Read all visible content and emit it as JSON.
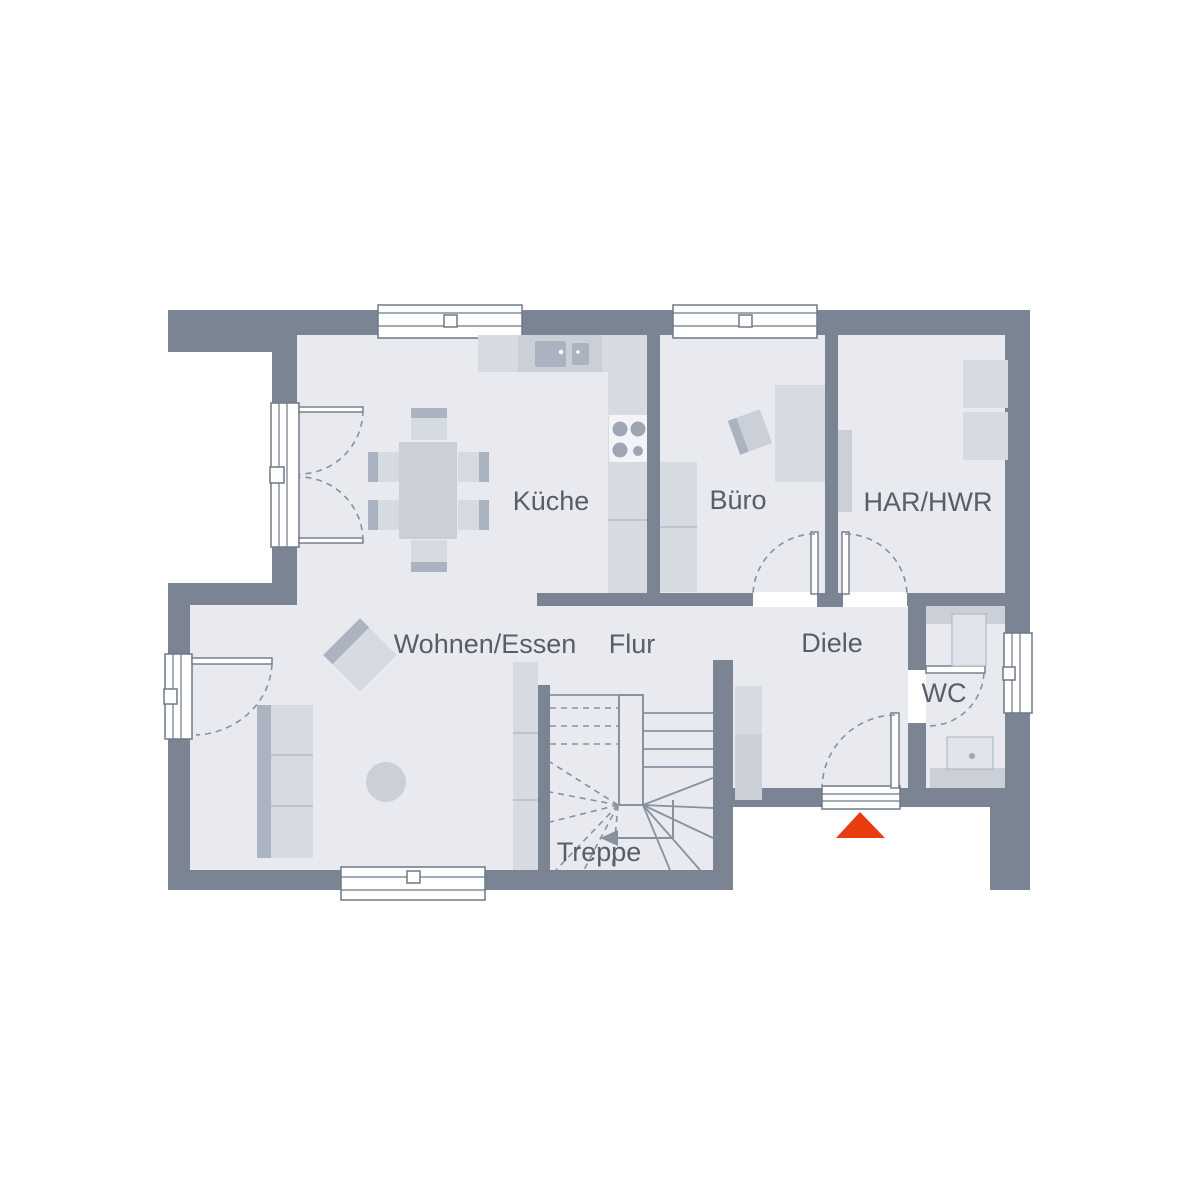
{
  "rooms": [
    {
      "id": "kueche",
      "label": "Küche"
    },
    {
      "id": "buero",
      "label": "Büro"
    },
    {
      "id": "har-hwr",
      "label": "HAR/HWR"
    },
    {
      "id": "wohnen-essen",
      "label": "Wohnen/Essen"
    },
    {
      "id": "flur",
      "label": "Flur"
    },
    {
      "id": "diele",
      "label": "Diele"
    },
    {
      "id": "wc",
      "label": "WC"
    },
    {
      "id": "treppe",
      "label": "Treppe"
    }
  ],
  "entrance_marker": {
    "icon": "entrance-triangle",
    "color": "#e83b10"
  },
  "colors": {
    "outside": "#ffffff",
    "wall": "#7b8493",
    "floor": "#e8eaef",
    "furn_light": "#d6dae1",
    "furn_mid": "#cbcfd8",
    "furn_dark": "#acb3c0",
    "fixture": "#e0e3e9",
    "stove": "#f2f4f7",
    "burner": "#9ea6b3",
    "line": "#8791a0",
    "divider": "#b6bcc8",
    "frame": "#6e7888",
    "label": "#585e68",
    "entrance": "#e83b10"
  }
}
